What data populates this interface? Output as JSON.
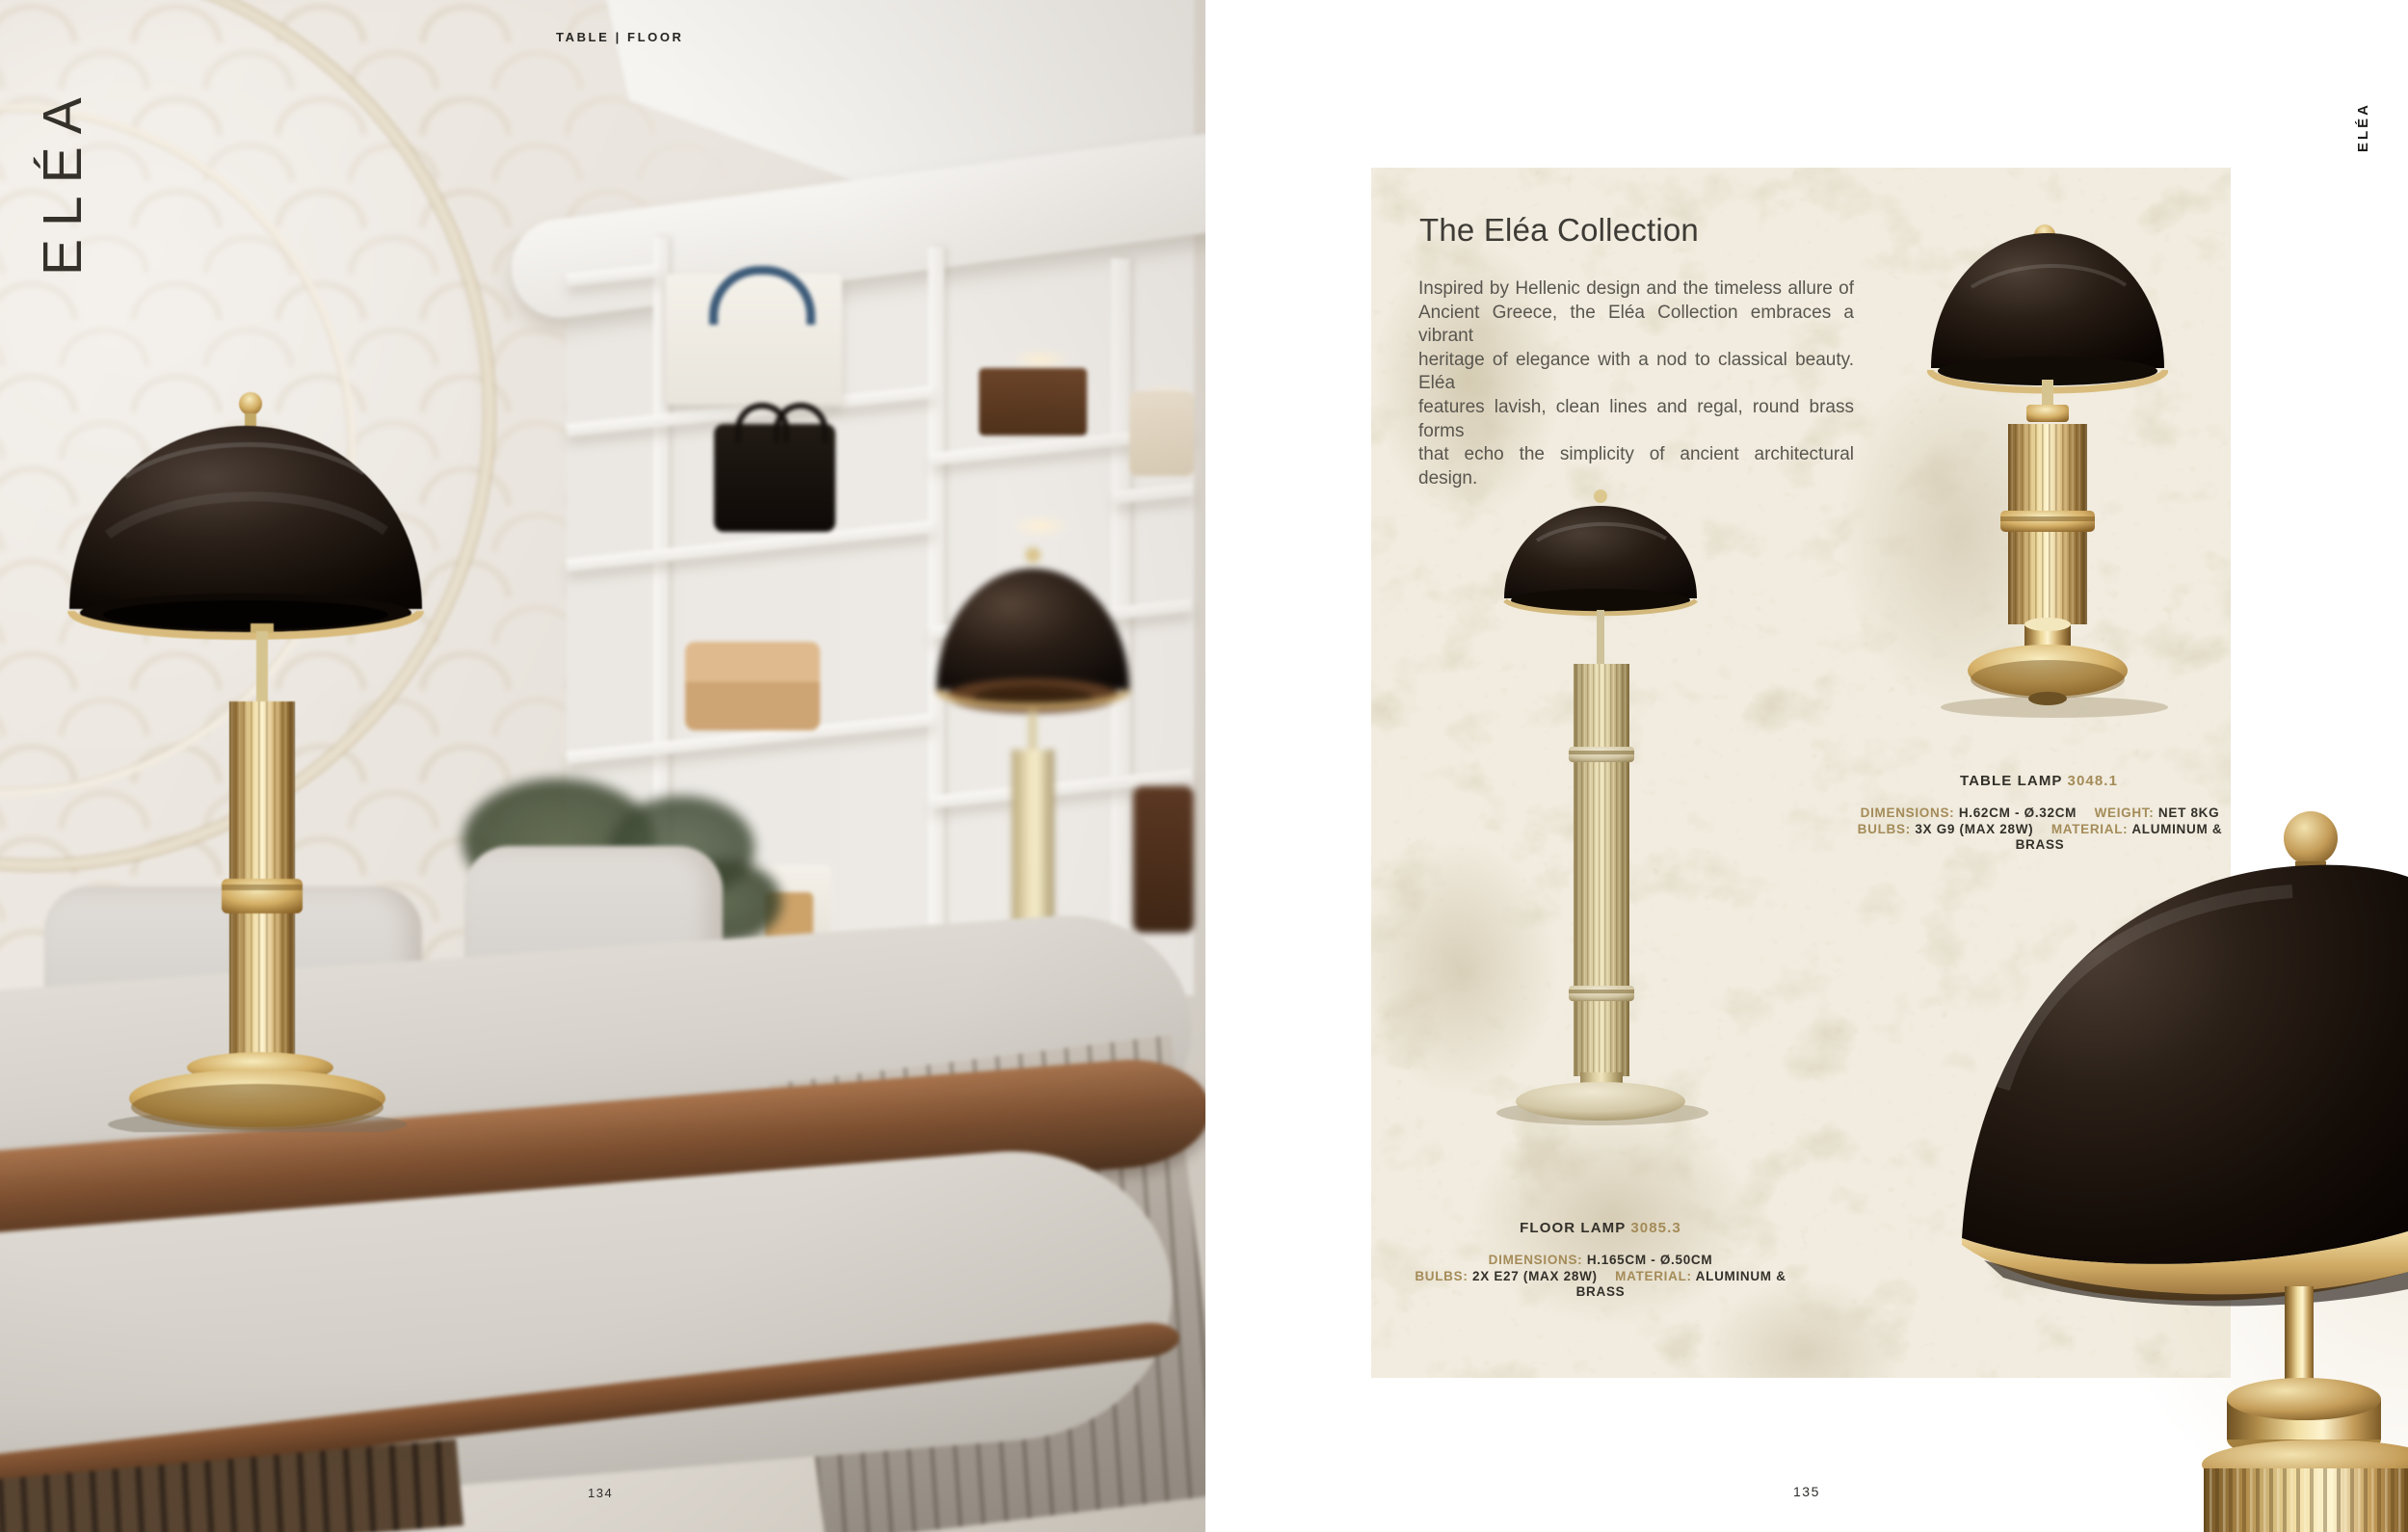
{
  "page": {
    "left_number": "134",
    "right_number": "135"
  },
  "photo": {
    "header": "TABLE | FLOOR",
    "brand_vertical": "ELÉA"
  },
  "brand_vertical_right": "ELÉA",
  "card": {
    "title": "The Eléa Collection",
    "paragraph_lines": [
      "Inspired by Hellenic design and the timeless allure of",
      "Ancient Greece, the Eléa Collection embraces a vibrant",
      "heritage of elegance with a nod to classical beauty. Eléa",
      "features lavish, clean lines and regal, round brass forms",
      "that echo the simplicity of ancient architectural design."
    ]
  },
  "products": {
    "table_lamp": {
      "label": "TABLE LAMP",
      "code": "3048.1",
      "specs": {
        "dimensions_label": "DIMENSIONS:",
        "dimensions": "H.62CM - Ø.32CM",
        "weight_label": "WEIGHT:",
        "weight": "NET 8KG",
        "bulbs_label": "BULBS:",
        "bulbs": "3X G9 (MAX 28W)",
        "material_label": "MATERIAL:",
        "material": "ALUMINUM & BRASS"
      }
    },
    "floor_lamp": {
      "label": "FLOOR LAMP",
      "code": "3085.3",
      "specs": {
        "dimensions_label": "DIMENSIONS:",
        "dimensions": "H.165CM - Ø.50CM",
        "bulbs_label": "BULBS:",
        "bulbs": "2X E27 (MAX 28W)",
        "material_label": "MATERIAL:",
        "material": "ALUMINUM & BRASS"
      }
    }
  },
  "colors": {
    "accent_gold": "#a48b58",
    "card_background": "#f1ecdf",
    "title_text": "#3e3b36",
    "body_text": "#59564f",
    "dark_text": "#2b2a28"
  }
}
